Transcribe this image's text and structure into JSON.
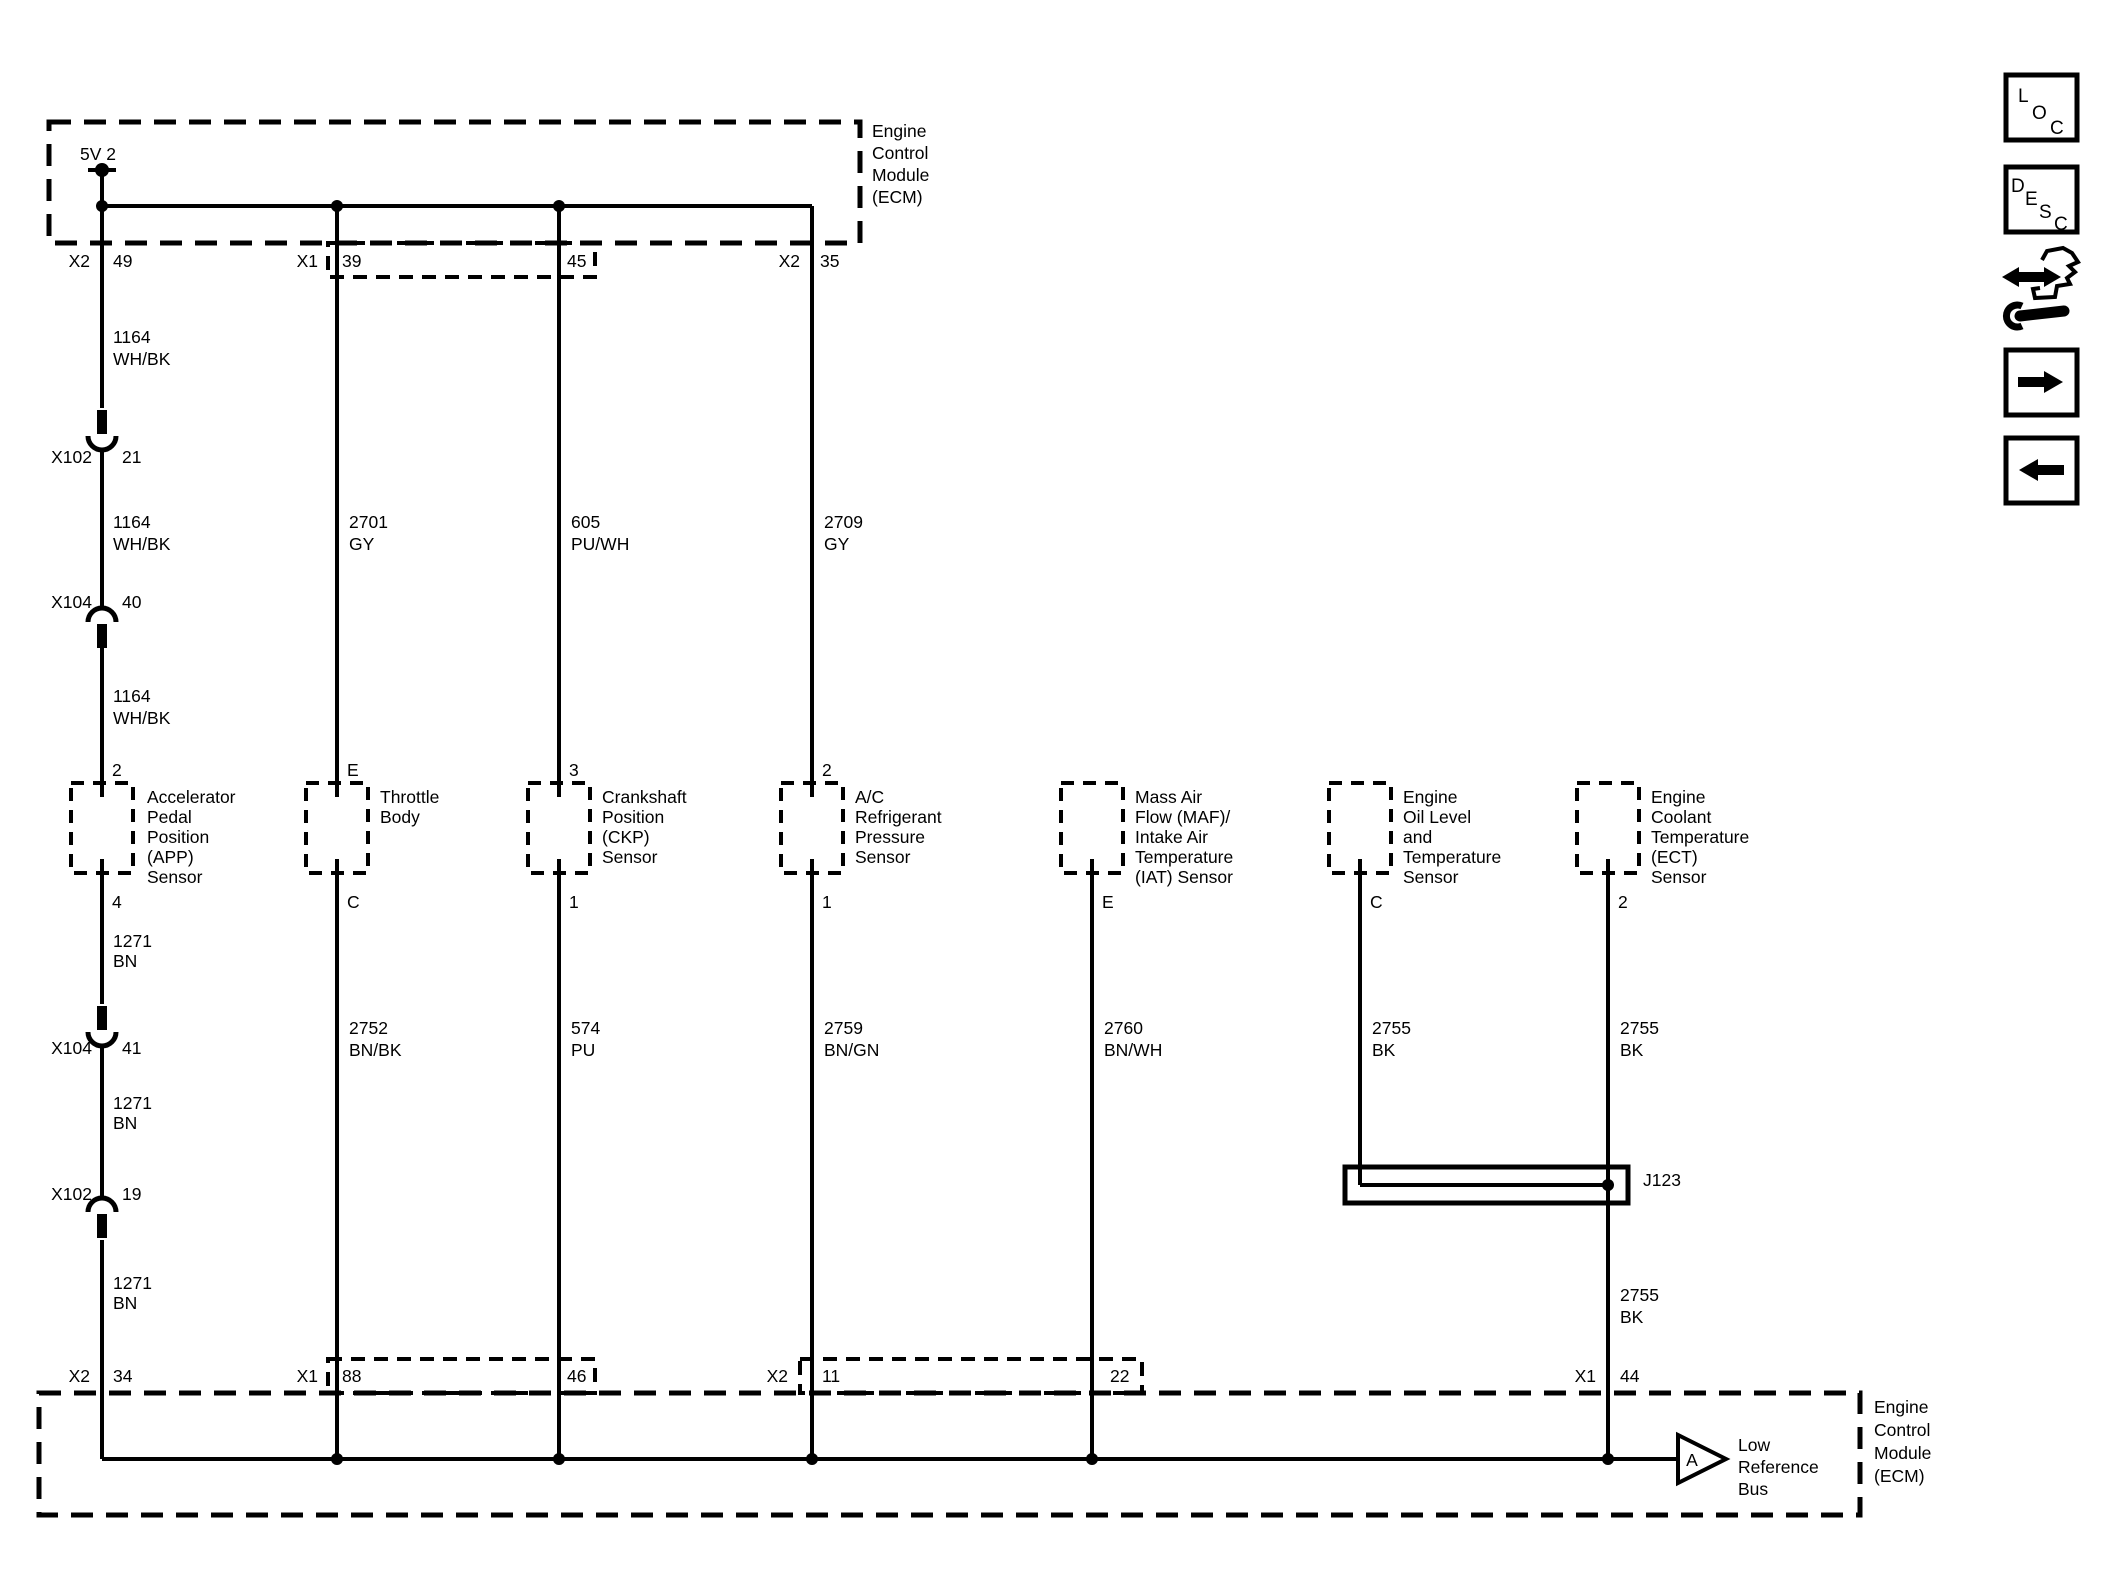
{
  "colors": {
    "ink": "#000000",
    "bg": "#ffffff"
  },
  "ecm_top": {
    "name_lines": [
      "Engine",
      "Control",
      "Module",
      "(ECM)"
    ],
    "power_tap": "5V 2",
    "pins": {
      "p49": {
        "conn": "X2",
        "num": "49"
      },
      "p39": {
        "conn": "X1",
        "num": "39"
      },
      "p45": {
        "num": "45"
      },
      "p35": {
        "conn": "X2",
        "num": "35"
      }
    }
  },
  "ecm_bottom": {
    "name_lines": [
      "Engine",
      "Control",
      "Module",
      "(ECM)"
    ],
    "pins": {
      "p34": {
        "conn": "X2",
        "num": "34"
      },
      "p88": {
        "conn": "X1",
        "num": "88"
      },
      "p46": {
        "num": "46"
      },
      "p11": {
        "conn": "X2",
        "num": "11"
      },
      "p22": {
        "num": "22"
      },
      "p44": {
        "conn": "X1",
        "num": "44"
      }
    },
    "low_reference_bus": {
      "arrow_letter": "A",
      "label_lines": [
        "Low",
        "Reference",
        "Bus"
      ]
    }
  },
  "inline_connectors": {
    "x102_21": {
      "name": "X102",
      "cavity": "21"
    },
    "x104_40": {
      "name": "X104",
      "cavity": "40"
    },
    "x104_41": {
      "name": "X104",
      "cavity": "41"
    },
    "x102_19": {
      "name": "X102",
      "cavity": "19"
    }
  },
  "splice": {
    "label": "J123"
  },
  "wires": {
    "w1164_a": {
      "circuit": "1164",
      "color": "WH/BK"
    },
    "w1164_b": {
      "circuit": "1164",
      "color": "WH/BK"
    },
    "w1164_c": {
      "circuit": "1164",
      "color": "WH/BK"
    },
    "w2701": {
      "circuit": "2701",
      "color": "GY"
    },
    "w605": {
      "circuit": "605",
      "color": "PU/WH"
    },
    "w2709": {
      "circuit": "2709",
      "color": "GY"
    },
    "w1271_a": {
      "circuit": "1271",
      "color": "BN"
    },
    "w1271_b": {
      "circuit": "1271",
      "color": "BN"
    },
    "w1271_c": {
      "circuit": "1271",
      "color": "BN"
    },
    "w2752": {
      "circuit": "2752",
      "color": "BN/BK"
    },
    "w574": {
      "circuit": "574",
      "color": "PU"
    },
    "w2759": {
      "circuit": "2759",
      "color": "BN/GN"
    },
    "w2760": {
      "circuit": "2760",
      "color": "BN/WH"
    },
    "w2755_a": {
      "circuit": "2755",
      "color": "BK"
    },
    "w2755_b": {
      "circuit": "2755",
      "color": "BK"
    },
    "w2755_c": {
      "circuit": "2755",
      "color": "BK"
    }
  },
  "sensors": {
    "app": {
      "pin_top": "2",
      "pin_bottom": "4",
      "name_lines": [
        "Accelerator",
        "Pedal",
        "Position",
        "(APP)",
        "Sensor"
      ]
    },
    "throttle": {
      "pin_top": "E",
      "pin_bottom": "C",
      "name_lines": [
        "Throttle",
        "Body"
      ]
    },
    "ckp": {
      "pin_top": "3",
      "pin_bottom": "1",
      "name_lines": [
        "Crankshaft",
        "Position",
        "(CKP)",
        "Sensor"
      ]
    },
    "ac_pressure": {
      "pin_top": "2",
      "pin_bottom": "1",
      "name_lines": [
        "A/C",
        "Refrigerant",
        "Pressure",
        "Sensor"
      ]
    },
    "maf_iat": {
      "pin_bottom": "E",
      "name_lines": [
        "Mass Air",
        "Flow (MAF)/",
        "Intake Air",
        "Temperature",
        "(IAT) Sensor"
      ]
    },
    "oil": {
      "pin_bottom": "C",
      "name_lines": [
        "Engine",
        "Oil Level",
        "and",
        "Temperature",
        "Sensor"
      ]
    },
    "ect": {
      "pin_bottom": "2",
      "name_lines": [
        "Engine",
        "Coolant",
        "Temperature",
        "(ECT)",
        "Sensor"
      ]
    }
  },
  "sidebar": {
    "loc_letters": [
      "L",
      "O",
      "C"
    ],
    "desc_letters": [
      "D",
      "E",
      "S",
      "C"
    ]
  }
}
